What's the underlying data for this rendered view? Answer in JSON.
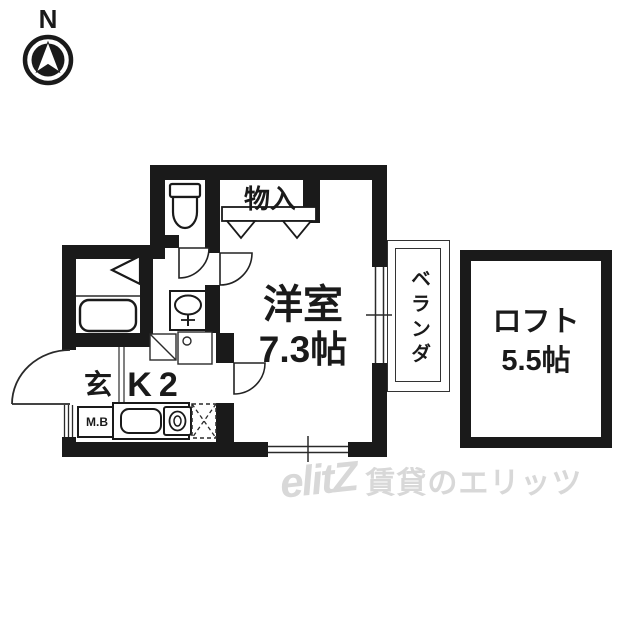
{
  "compass": {
    "label": "N"
  },
  "plan": {
    "storage": {
      "label": "物入"
    },
    "western_room": {
      "label": "洋室",
      "size": "7.3帖"
    },
    "balcony": {
      "label": "ベランダ"
    },
    "entrance": {
      "label": "玄"
    },
    "kitchen": {
      "label": "K2"
    },
    "meter_box": {
      "label": "M.B"
    }
  },
  "loft": {
    "label": "ロフト",
    "size": "5.5帖"
  },
  "watermark": {
    "logo": "elitZ",
    "text": "賃貸のエリッツ"
  },
  "icons": {
    "compass": "north-arrow-icon",
    "fixtures": [
      "toilet-icon",
      "bathtub-icon",
      "washbasin-icon",
      "kitchen-sink-icon",
      "stove-icon",
      "washing-machine-space",
      "refrigerator-space",
      "closet-door-triangles",
      "door-swing-arc",
      "window",
      "meter-box-hatch"
    ]
  },
  "colors": {
    "wall": "#1a1a1a",
    "line": "#2a2a2a",
    "watermark": "#d8d8d8",
    "background": "#ffffff"
  }
}
